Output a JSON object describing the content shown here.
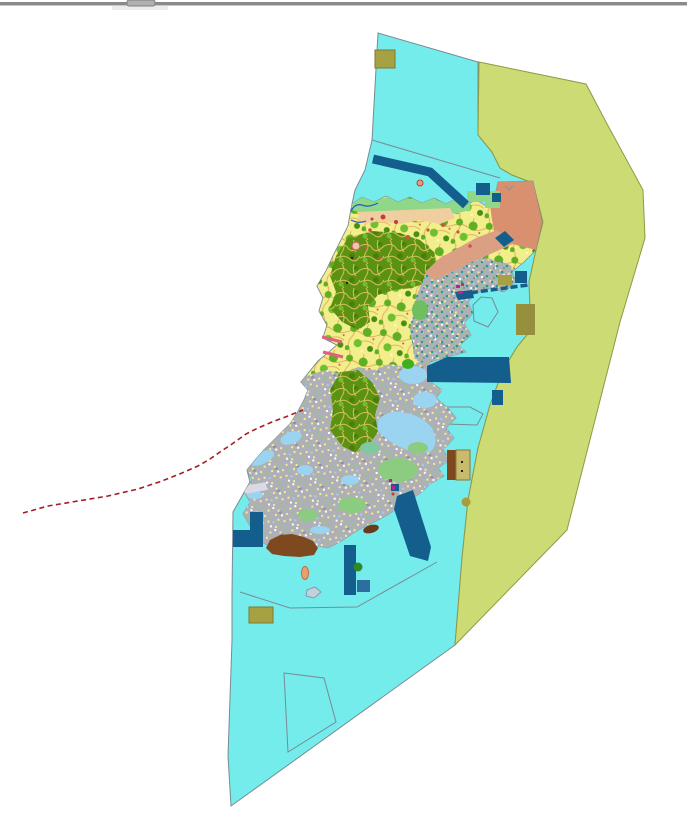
{
  "chrome": {
    "top_bar_color": "#8A8A8A",
    "top_bar_edge_color": "#C8C8C8",
    "grip_tab_color": "#B0B0B0",
    "grip_border_color": "#808080",
    "grip_shadow_color": "#ECECEC"
  },
  "palette": {
    "white": "#FFFFFF",
    "sea_cyan": "#74ECEC",
    "offshore_olive": "#CCDB73",
    "olive_border": "#8F9945",
    "boundary_gray": "#7A8A93",
    "navy": "#145E8E",
    "medium_blue": "#2E6E9E",
    "salmon": "#D8906E",
    "salmon_light": "#DBA083",
    "coastal_green": "#8FD88A",
    "sand_tan": "#EFCFA0",
    "parcel_yellow": "#F2EE8C",
    "parcel_line_orange": "#E2A85C",
    "forest_green": "#5FAF22",
    "forest_green_dark": "#478F12",
    "forest_green_light": "#6FBF2F",
    "dense_forest": "#5C9212",
    "dense_forest_dark": "#4A7F0C",
    "dense_vein": "#D8C060",
    "urban_gray": "#AFAFB7",
    "urban_gray_dark": "#90909A",
    "light_blue": "#9AD4F0",
    "lavender": "#D9D9E8",
    "light_green": "#8CCC80",
    "teal_green": "#7FC8A0",
    "mid_green": "#6FBF60",
    "bright_green": "#3FAF1F",
    "dark_green": "#2E8B22",
    "teal": "#1F9E8E",
    "brown": "#7E491F",
    "coast_brown": "#6B3A1A",
    "khaki": "#A6A143",
    "khaki_border": "#7E7A30",
    "dark_khaki": "#96903E",
    "tan": "#C9BA6C",
    "tan_border": "#8A7A30",
    "khaki_circle": "#AD9A3A",
    "red_line": "#A51C24",
    "pink": "#E06080",
    "magenta": "#C02090",
    "red_spot": "#C04030",
    "red_dot": "#CC5544",
    "river_blue": "#2255CC",
    "islet_salmon": "#E8A070",
    "islet_salmon_border": "#C07040",
    "islet_gray": "#C2D2DC",
    "islet_gray_border": "#8899AA",
    "ring_fill": "#F0C8A8",
    "ring_border": "#C06868",
    "speck_white": "#FCFCC8",
    "dot_black": "#222222"
  }
}
